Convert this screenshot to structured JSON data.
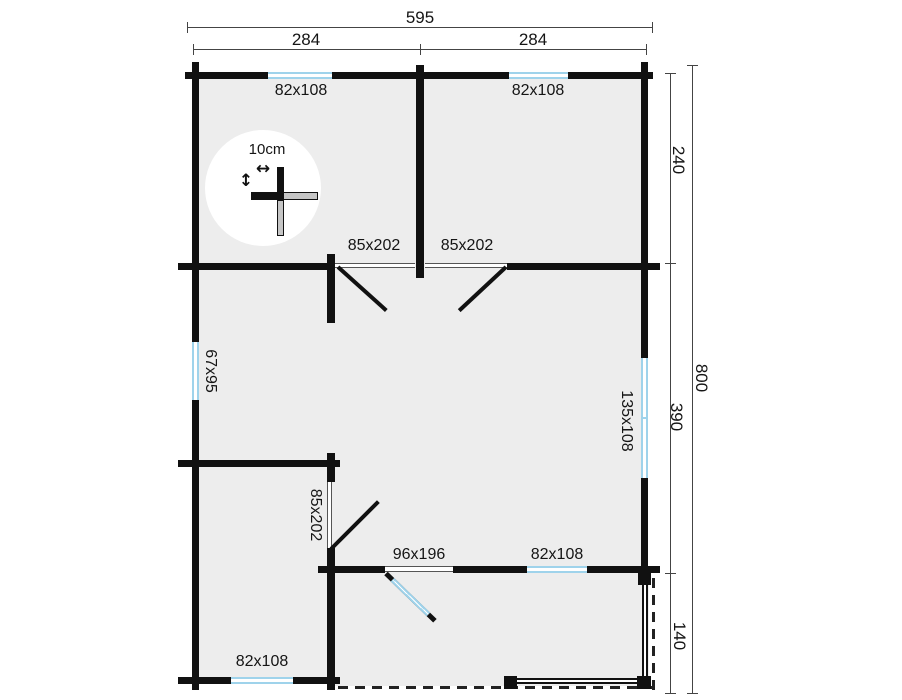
{
  "plan": {
    "dims": {
      "total_width": "595",
      "width_left": "284",
      "width_right": "284",
      "depth_top": "240",
      "depth_middle": "390",
      "depth_bottom": "140",
      "depth_total": "800"
    },
    "windows": {
      "top_left": "82x108",
      "top_right": "82x108",
      "left_side": "67x95",
      "right_side": "135x108",
      "inner_bottom": "82x108",
      "bottom_left": "82x108"
    },
    "doors": {
      "interior_left": "85x202",
      "interior_right": "85x202",
      "interior_lower": "85x202",
      "entry_door": "96x196"
    },
    "scale": {
      "label": "10cm"
    },
    "icons": {
      "width_arrow": "↔",
      "height_arrow": "↕"
    },
    "colors": {
      "wall": "#111111",
      "window_blue": "#9fd3eb",
      "room_fill": "#ededed",
      "dim_line": "#444444"
    }
  }
}
